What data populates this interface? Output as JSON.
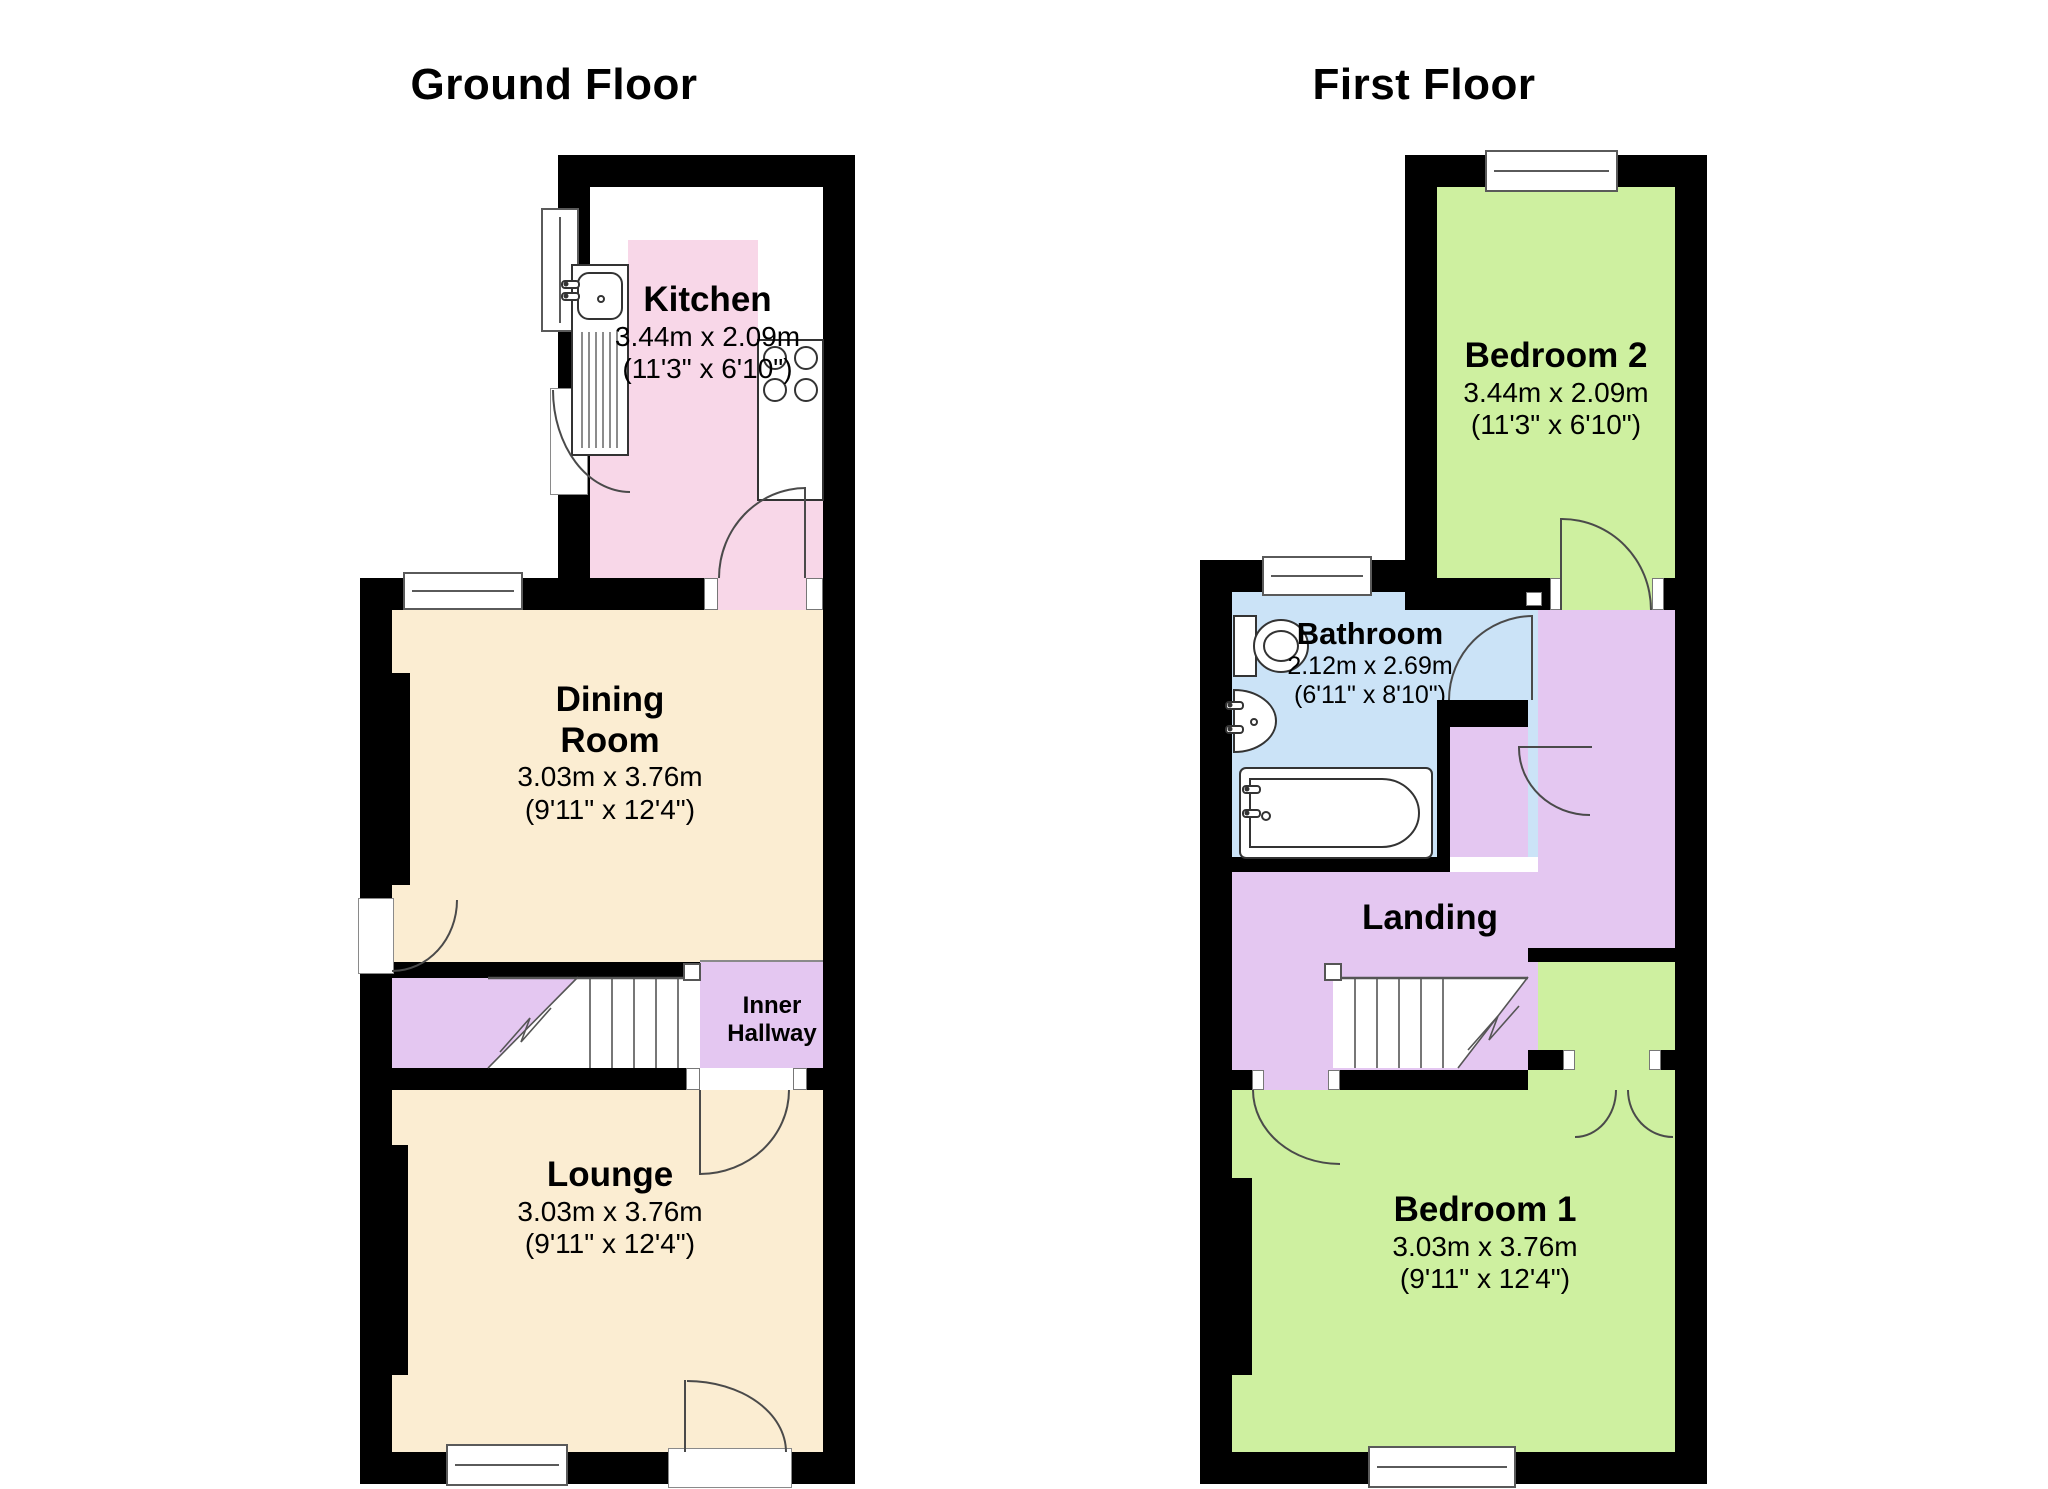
{
  "titles": {
    "ground": "Ground Floor",
    "first": "First Floor"
  },
  "ground": {
    "kitchen": {
      "name": "Kitchen",
      "metric": "3.44m x 2.09m",
      "imperial": "(11'3\" x 6'10\")"
    },
    "dining": {
      "name_line1": "Dining",
      "name_line2": "Room",
      "metric": "3.03m x 3.76m",
      "imperial": "(9'11\" x 12'4\")"
    },
    "hallway": {
      "name_line1": "Inner",
      "name_line2": "Hallway"
    },
    "lounge": {
      "name": "Lounge",
      "metric": "3.03m x 3.76m",
      "imperial": "(9'11\" x 12'4\")"
    }
  },
  "first": {
    "bedroom2": {
      "name": "Bedroom 2",
      "metric": "3.44m x 2.09m",
      "imperial": "(11'3\" x 6'10\")"
    },
    "bathroom": {
      "name": "Bathroom",
      "metric": "2.12m x 2.69m",
      "imperial": "(6'11\" x 8'10\")"
    },
    "landing": {
      "name": "Landing"
    },
    "bedroom1": {
      "name": "Bedroom 1",
      "metric": "3.03m x 3.76m",
      "imperial": "(9'11\" x 12'4\")"
    }
  },
  "colors": {
    "kitchen": "#F8D7E8",
    "living": "#FBEDD2",
    "circulation": "#E4C7F1",
    "bedroom": "#CEF0A0",
    "bathroom": "#CBE3F7",
    "wall": "#000000",
    "fixture_stroke": "#333333"
  }
}
